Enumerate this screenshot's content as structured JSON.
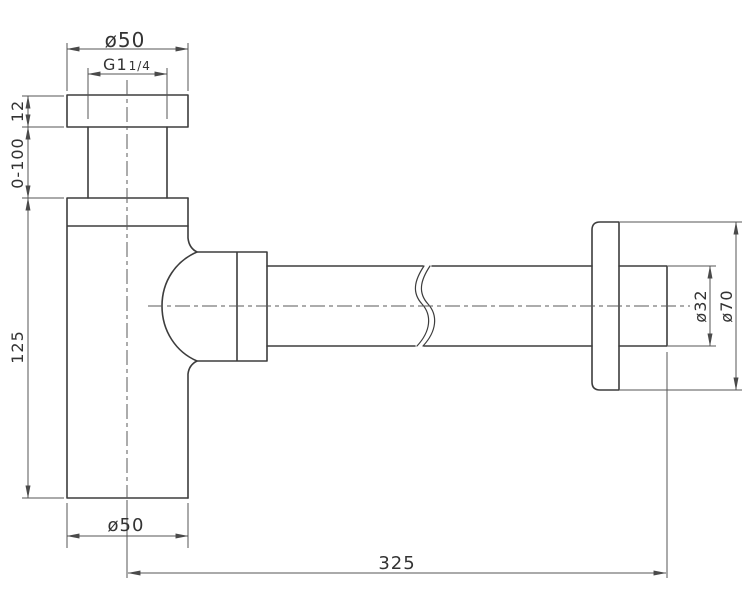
{
  "page": {
    "background": "#ffffff",
    "object_line_color": "#3d3d3d",
    "dimension_line_color": "#555555",
    "centerline_color": "#5a5a5a",
    "text_color": "#333333"
  },
  "drawing": {
    "kind": "technical-drawing",
    "subject": "bottle-trap-siphon-side-view",
    "dimensions": {
      "top_outer_diameter": "ø50",
      "thread_size_main": "G1",
      "thread_size_fraction": "1/4",
      "flange_thickness": "12",
      "adjustable_range": "0-100",
      "body_height": "125",
      "body_diameter": "ø50",
      "overall_length": "325",
      "outlet_pipe_diameter": "ø32",
      "wall_flange_diameter": "ø70"
    }
  }
}
